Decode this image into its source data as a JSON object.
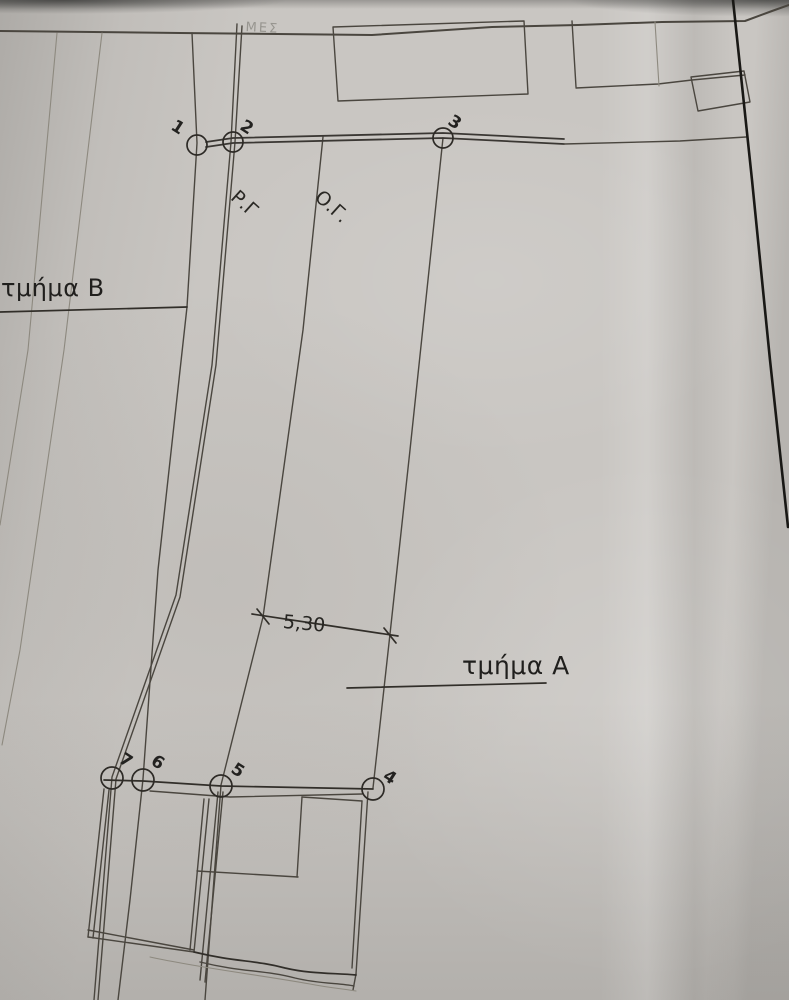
{
  "texts": {
    "section_a": "τμήμα Α",
    "section_b": "τμήμα Β",
    "rg": "Ρ.Γ",
    "og": "Ο.Γ.",
    "dimension": "5,30",
    "faint_note": "ΜΕΣ"
  },
  "colors": {
    "paper": "#c9c6c2",
    "ink_faint": "#8d897f",
    "ink": "#4a463f",
    "ink_dark": "#312e29",
    "ink_black": "#191815"
  },
  "points": [
    {
      "id": "1",
      "cx": 197,
      "cy": 145,
      "r": 10,
      "lx": 178,
      "ly": 116
    },
    {
      "id": "2",
      "cx": 233,
      "cy": 142,
      "r": 10,
      "lx": 247,
      "ly": 116
    },
    {
      "id": "3",
      "cx": 443,
      "cy": 138,
      "r": 10,
      "lx": 455,
      "ly": 111
    },
    {
      "id": "4",
      "cx": 373,
      "cy": 789,
      "r": 11,
      "lx": 390,
      "ly": 766
    },
    {
      "id": "5",
      "cx": 221,
      "cy": 786,
      "r": 11,
      "lx": 238,
      "ly": 759
    },
    {
      "id": "6",
      "cx": 143,
      "cy": 780,
      "r": 11,
      "lx": 158,
      "ly": 751
    },
    {
      "id": "7",
      "cx": 112,
      "cy": 778,
      "r": 11,
      "lx": 126,
      "ly": 749
    }
  ],
  "geometry": {
    "dots": [
      {
        "n": "section-b-dot",
        "cx": 187,
        "cy": 307,
        "r": 5.5
      },
      {
        "n": "section-a-dot",
        "cx": 347,
        "cy": 688,
        "r": 5.5
      }
    ],
    "lines": [
      {
        "n": "top-border",
        "s": "b",
        "p": [
          [
            0,
            31
          ],
          [
            180,
            33
          ],
          [
            372,
            35
          ],
          [
            492,
            27
          ],
          [
            578,
            25
          ],
          [
            662,
            22
          ],
          [
            745,
            21
          ],
          [
            772,
            11
          ],
          [
            789,
            5
          ]
        ]
      },
      {
        "n": "boundary-a",
        "s": "f",
        "p": [
          [
            57,
            33
          ],
          [
            28,
            350
          ],
          [
            0,
            525
          ]
        ]
      },
      {
        "n": "boundary-b",
        "s": "f",
        "p": [
          [
            102,
            33
          ],
          [
            64,
            350
          ],
          [
            20,
            650
          ],
          [
            2,
            745
          ]
        ]
      },
      {
        "n": "boundary-through-point-1",
        "s": "m",
        "p": [
          [
            192,
            33
          ],
          [
            197,
            143
          ],
          [
            187,
            307
          ],
          [
            158,
            570
          ],
          [
            143,
            779
          ],
          [
            130,
            900
          ],
          [
            118,
            1000
          ]
        ]
      },
      {
        "n": "rg-line-1",
        "s": "m",
        "p": [
          [
            237,
            24
          ],
          [
            231,
            142
          ],
          [
            212,
            365
          ],
          [
            176,
            595
          ],
          [
            112,
            777
          ],
          [
            94,
            1000
          ]
        ]
      },
      {
        "n": "rg-line-2",
        "s": "m",
        "p": [
          [
            242,
            26
          ],
          [
            235,
            142
          ],
          [
            216,
            365
          ],
          [
            180,
            597
          ],
          [
            116,
            779
          ],
          [
            98,
            1000
          ]
        ]
      },
      {
        "n": "og-line",
        "s": "m",
        "p": [
          [
            323,
            137
          ],
          [
            303,
            330
          ],
          [
            263,
            617
          ],
          [
            221,
            785
          ],
          [
            205,
            1000
          ]
        ]
      },
      {
        "n": "boundary-through-point-3",
        "s": "m",
        "p": [
          [
            443,
            138
          ],
          [
            410,
            450
          ],
          [
            390,
            634
          ],
          [
            373,
            788
          ]
        ]
      },
      {
        "n": "street-line-upper",
        "s": "s",
        "p": [
          [
            206,
            142
          ],
          [
            233,
            138
          ],
          [
            443,
            133
          ],
          [
            564,
            139
          ]
        ]
      },
      {
        "n": "street-line-lower",
        "s": "s",
        "p": [
          [
            206,
            147
          ],
          [
            233,
            143
          ],
          [
            443,
            138
          ],
          [
            564,
            144
          ]
        ]
      },
      {
        "n": "street-line-right",
        "s": "m",
        "p": [
          [
            564,
            144
          ],
          [
            680,
            141
          ],
          [
            746,
            137
          ]
        ]
      },
      {
        "n": "top-rectangle",
        "s": "m",
        "p": [
          [
            333,
            27
          ],
          [
            524,
            21
          ],
          [
            528,
            94
          ],
          [
            338,
            101
          ],
          [
            333,
            27
          ]
        ]
      },
      {
        "n": "stub-vertical-1",
        "s": "m",
        "p": [
          [
            572,
            21
          ],
          [
            576,
            87
          ]
        ]
      },
      {
        "n": "upper-horizontal",
        "s": "m",
        "p": [
          [
            576,
            88
          ],
          [
            658,
            84
          ],
          [
            692,
            80
          ],
          [
            745,
            75
          ]
        ]
      },
      {
        "n": "stub-vertical-2",
        "s": "f",
        "p": [
          [
            655,
            22
          ],
          [
            659,
            86
          ]
        ]
      },
      {
        "n": "small-rectangle",
        "s": "m",
        "p": [
          [
            691,
            77
          ],
          [
            744,
            71
          ],
          [
            750,
            102
          ],
          [
            698,
            111
          ],
          [
            691,
            77
          ]
        ]
      },
      {
        "n": "dark-edge-line",
        "s": "k",
        "p": [
          [
            733,
            0
          ],
          [
            752,
            180
          ],
          [
            770,
            360
          ],
          [
            788,
            527
          ]
        ]
      },
      {
        "n": "section-b-leader",
        "s": "d",
        "p": [
          [
            0,
            312
          ],
          [
            187,
            307
          ]
        ]
      },
      {
        "n": "section-a-leader",
        "s": "d",
        "p": [
          [
            347,
            688
          ],
          [
            546,
            683
          ]
        ]
      },
      {
        "n": "dimension-line",
        "s": "d",
        "p": [
          [
            252,
            614
          ],
          [
            325,
            625
          ],
          [
            398,
            636
          ]
        ]
      },
      {
        "n": "dimension-tick-left",
        "s": "d",
        "p": [
          [
            257,
            609
          ],
          [
            269,
            624
          ]
        ]
      },
      {
        "n": "dimension-tick-right",
        "s": "d",
        "p": [
          [
            384,
            628
          ],
          [
            396,
            643
          ]
        ]
      },
      {
        "n": "chain-line-7-to-4",
        "s": "d",
        "p": [
          [
            104,
            780
          ],
          [
            143,
            781
          ],
          [
            221,
            786
          ],
          [
            373,
            789
          ]
        ]
      },
      {
        "n": "building-top-second",
        "s": "m",
        "p": [
          [
            150,
            791
          ],
          [
            230,
            797
          ],
          [
            362,
            794
          ]
        ]
      },
      {
        "n": "left-building-left-1",
        "s": "m",
        "p": [
          [
            104,
            789
          ],
          [
            88,
            937
          ]
        ]
      },
      {
        "n": "left-building-left-2",
        "s": "m",
        "p": [
          [
            109,
            790
          ],
          [
            93,
            938
          ]
        ]
      },
      {
        "n": "left-building-right-1",
        "s": "m",
        "p": [
          [
            209,
            799
          ],
          [
            194,
            952
          ]
        ]
      },
      {
        "n": "left-building-right-2",
        "s": "m",
        "p": [
          [
            204,
            799
          ],
          [
            190,
            950
          ]
        ]
      },
      {
        "n": "left-building-bottom-1",
        "s": "m",
        "p": [
          [
            88,
            937
          ],
          [
            194,
            952
          ]
        ]
      },
      {
        "n": "left-building-bottom-2",
        "s": "m",
        "p": [
          [
            88,
            930
          ],
          [
            194,
            950
          ]
        ]
      },
      {
        "n": "right-building-left-1",
        "s": "m",
        "p": [
          [
            218,
            792
          ],
          [
            200,
            980
          ]
        ]
      },
      {
        "n": "right-building-left-2",
        "s": "m",
        "p": [
          [
            223,
            792
          ],
          [
            205,
            982
          ]
        ]
      },
      {
        "n": "right-building-right-1",
        "s": "m",
        "p": [
          [
            368,
            792
          ],
          [
            356,
            974
          ]
        ]
      },
      {
        "n": "right-building-right-2",
        "s": "m",
        "p": [
          [
            362,
            801
          ],
          [
            352,
            968
          ]
        ]
      },
      {
        "n": "notch-top",
        "s": "m",
        "p": [
          [
            302,
            797
          ],
          [
            362,
            801
          ]
        ]
      },
      {
        "n": "notch-left",
        "s": "m",
        "p": [
          [
            302,
            797
          ],
          [
            297,
            877
          ]
        ]
      },
      {
        "n": "notch-bottom",
        "s": "m",
        "p": [
          [
            197,
            871
          ],
          [
            298,
            877
          ]
        ]
      },
      {
        "n": "right-building-corner",
        "s": "m",
        "p": [
          [
            356,
            974
          ],
          [
            353,
            990
          ]
        ]
      },
      {
        "n": "bottom-wavy-1",
        "s": "d",
        "d": "M194,952 C235,962 255,960 285,968 C310,974 335,973 356,975"
      },
      {
        "n": "bottom-wavy-2",
        "s": "m",
        "d": "M200,962 C240,972 265,970 295,978 C320,984 340,983 354,986"
      },
      {
        "n": "bottom-wavy-3",
        "s": "f",
        "d": "M150,957 C200,968 260,975 310,984 C330,988 345,989 356,991"
      }
    ]
  }
}
